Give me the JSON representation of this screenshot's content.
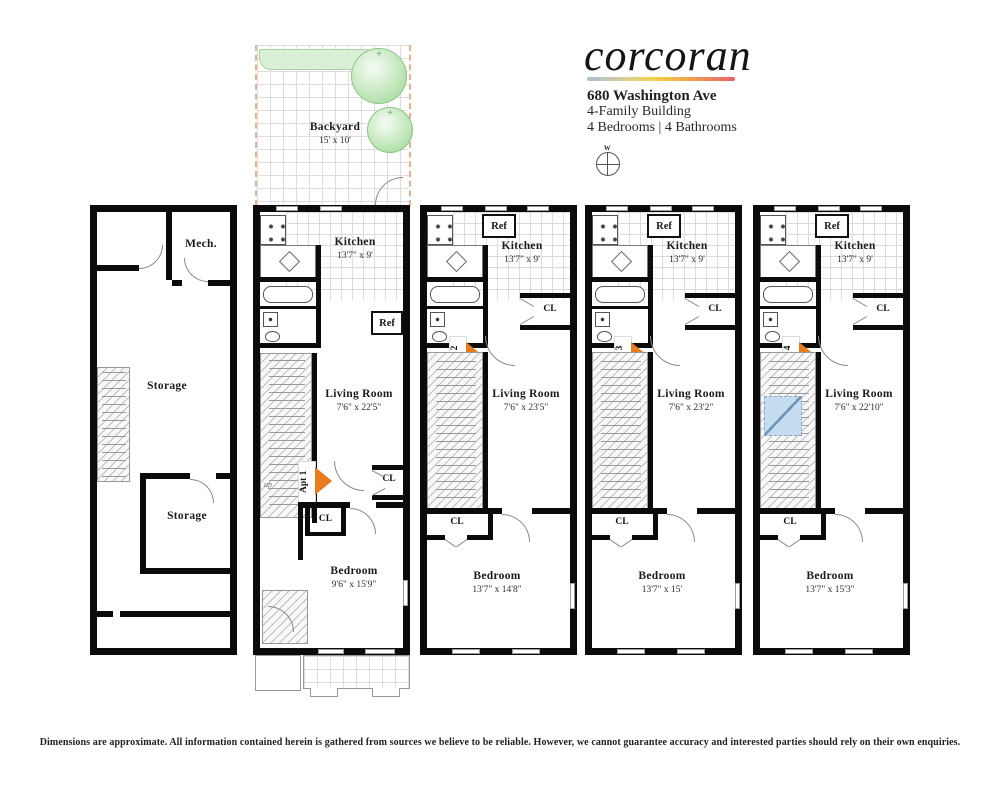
{
  "header": {
    "logo_text": "corcoran",
    "address": "680 Washington Ave",
    "building_type": "4-Family Building",
    "rooms_summary": "4 Bedrooms | 4 Bathrooms",
    "compass_label": "w"
  },
  "backyard": {
    "label": "Backyard",
    "dims": "15' x 10'"
  },
  "cellar": {
    "mech_label": "Mech.",
    "storage_upper_label": "Storage",
    "storage_lower_label": "Storage"
  },
  "apartments": [
    {
      "tag": "Apt 1",
      "kitchen_label": "Kitchen",
      "kitchen_dims": "13'7\" x 9'",
      "living_label": "Living Room",
      "living_dims": "7'6\" x 22'5\"",
      "bedroom_label": "Bedroom",
      "bedroom_dims": "9'6\" x 15'9\"",
      "ref_label": "Ref",
      "cl_right_label": "CL",
      "cl_bottom_label": "CL",
      "up_label": "up"
    },
    {
      "tag": "Apt 2",
      "kitchen_label": "Kitchen",
      "kitchen_dims": "13'7\" x 9'",
      "living_label": "Living Room",
      "living_dims": "7'6\" x 23'5\"",
      "bedroom_label": "Bedroom",
      "bedroom_dims": "13'7\" x 14'8\"",
      "ref_label": "Ref",
      "cl_right_label": "CL",
      "cl_bottom_label": "CL"
    },
    {
      "tag": "Apt 3",
      "kitchen_label": "Kitchen",
      "kitchen_dims": "13'7\" x 9'",
      "living_label": "Living Room",
      "living_dims": "7'6\" x 23'2\"",
      "bedroom_label": "Bedroom",
      "bedroom_dims": "13'7\" x 15'",
      "ref_label": "Ref",
      "cl_right_label": "CL",
      "cl_bottom_label": "CL"
    },
    {
      "tag": "Apt 4",
      "kitchen_label": "Kitchen",
      "kitchen_dims": "13'7\" x 9'",
      "living_label": "Living Room",
      "living_dims": "7'6\" x 22'10\"",
      "bedroom_label": "Bedroom",
      "bedroom_dims": "13'7\" x 15'3\"",
      "ref_label": "Ref",
      "cl_right_label": "CL",
      "cl_bottom_label": "CL"
    }
  ],
  "footer": {
    "disclaimer": "Dimensions are approximate. All information contained herein is gathered from sources we believe to be reliable. However, we cannot guarantee accuracy and interested parties should rely on their own enquiries."
  },
  "colors": {
    "wall_black": "#0b0b0b",
    "accent_orange": "#ea7a20",
    "tree_green": "#9ad392",
    "planting_bed_green": "#d9f0d6",
    "skylight_blue": "#c6ddef",
    "backyard_dashed_orange": "#f2b08a",
    "logo_gradient": [
      "#a9bdd1",
      "#f2d24b",
      "#f0a24e",
      "#e95f6b"
    ]
  }
}
